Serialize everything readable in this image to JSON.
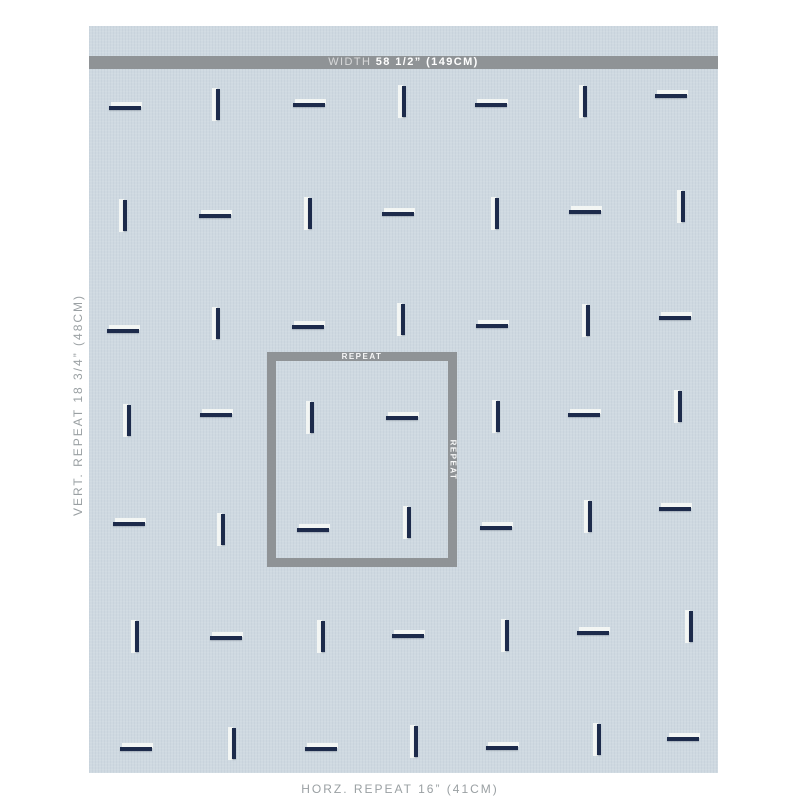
{
  "measurements": {
    "width_prefix": "WIDTH ",
    "width_value": "58 1/2” (149CM)",
    "vert_repeat": "VERT. REPEAT 18 3/4” (48CM)",
    "horz_repeat": "HORZ. REPEAT 16” (41CM)",
    "repeat_label": "REPEAT",
    "repeat_label_side": "REPEAT"
  },
  "colors": {
    "page_background": "#ffffff",
    "fabric_background": "#cfd9e1",
    "measure_gray": "#8f9396",
    "label_gray": "#9aa0a3",
    "stitch_navy": "#1d2b4b",
    "stitch_white": "#f3f6f4"
  },
  "fabric": {
    "left": 89,
    "top": 26,
    "width": 629,
    "height": 747
  },
  "width_bar": {
    "top": 56,
    "height": 13
  },
  "repeat_box": {
    "left": 267,
    "top": 352,
    "width": 190,
    "height": 215
  },
  "marks": [
    {
      "x": 126,
      "y": 107,
      "o": "h"
    },
    {
      "x": 217,
      "y": 105,
      "o": "v"
    },
    {
      "x": 310,
      "y": 104,
      "o": "h"
    },
    {
      "x": 403,
      "y": 102,
      "o": "v"
    },
    {
      "x": 492,
      "y": 104,
      "o": "h"
    },
    {
      "x": 584,
      "y": 102,
      "o": "v"
    },
    {
      "x": 672,
      "y": 95,
      "o": "h"
    },
    {
      "x": 124,
      "y": 216,
      "o": "v"
    },
    {
      "x": 216,
      "y": 215,
      "o": "h"
    },
    {
      "x": 309,
      "y": 214,
      "o": "v"
    },
    {
      "x": 399,
      "y": 213,
      "o": "h"
    },
    {
      "x": 496,
      "y": 214,
      "o": "v"
    },
    {
      "x": 586,
      "y": 211,
      "o": "h"
    },
    {
      "x": 682,
      "y": 207,
      "o": "v"
    },
    {
      "x": 124,
      "y": 330,
      "o": "h"
    },
    {
      "x": 217,
      "y": 324,
      "o": "v"
    },
    {
      "x": 309,
      "y": 326,
      "o": "h"
    },
    {
      "x": 402,
      "y": 320,
      "o": "v"
    },
    {
      "x": 493,
      "y": 325,
      "o": "h"
    },
    {
      "x": 587,
      "y": 321,
      "o": "v"
    },
    {
      "x": 676,
      "y": 317,
      "o": "h"
    },
    {
      "x": 128,
      "y": 421,
      "o": "v"
    },
    {
      "x": 217,
      "y": 414,
      "o": "h"
    },
    {
      "x": 311,
      "y": 418,
      "o": "v"
    },
    {
      "x": 403,
      "y": 417,
      "o": "h"
    },
    {
      "x": 497,
      "y": 417,
      "o": "v"
    },
    {
      "x": 585,
      "y": 414,
      "o": "h"
    },
    {
      "x": 679,
      "y": 407,
      "o": "v"
    },
    {
      "x": 130,
      "y": 523,
      "o": "h"
    },
    {
      "x": 222,
      "y": 530,
      "o": "v"
    },
    {
      "x": 314,
      "y": 529,
      "o": "h"
    },
    {
      "x": 408,
      "y": 523,
      "o": "v"
    },
    {
      "x": 497,
      "y": 527,
      "o": "h"
    },
    {
      "x": 589,
      "y": 517,
      "o": "v"
    },
    {
      "x": 676,
      "y": 508,
      "o": "h"
    },
    {
      "x": 136,
      "y": 637,
      "o": "v"
    },
    {
      "x": 227,
      "y": 637,
      "o": "h"
    },
    {
      "x": 322,
      "y": 637,
      "o": "v"
    },
    {
      "x": 409,
      "y": 635,
      "o": "h"
    },
    {
      "x": 506,
      "y": 636,
      "o": "v"
    },
    {
      "x": 594,
      "y": 632,
      "o": "h"
    },
    {
      "x": 690,
      "y": 627,
      "o": "v"
    },
    {
      "x": 137,
      "y": 748,
      "o": "h"
    },
    {
      "x": 233,
      "y": 744,
      "o": "v"
    },
    {
      "x": 322,
      "y": 748,
      "o": "h"
    },
    {
      "x": 415,
      "y": 742,
      "o": "v"
    },
    {
      "x": 503,
      "y": 747,
      "o": "h"
    },
    {
      "x": 598,
      "y": 740,
      "o": "v"
    },
    {
      "x": 684,
      "y": 738,
      "o": "h"
    }
  ]
}
